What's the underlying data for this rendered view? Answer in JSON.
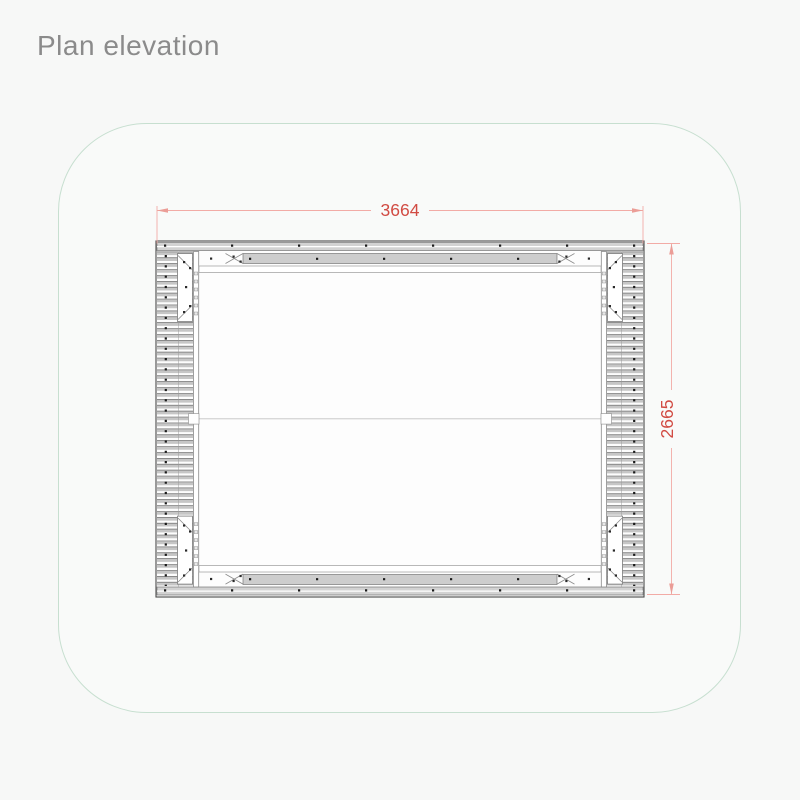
{
  "title": "Plan elevation",
  "drawing": {
    "name": "plan-elevation-cad-drawing",
    "description": "Plan view of rectangular frame with louvered side rails and corner brackets",
    "dimensions": {
      "width_label": "3664",
      "height_label": "2665"
    }
  },
  "colors": {
    "background": "#f7f8f7",
    "canvas_border_green": "#c7dfd0",
    "dimension_text": "#d14b43",
    "dimension_line": "#f2aba6",
    "frame_line": "#4a4a4a",
    "frame_fill_gray": "#d2d2d2",
    "louver_gray": "#c6c6c6"
  }
}
